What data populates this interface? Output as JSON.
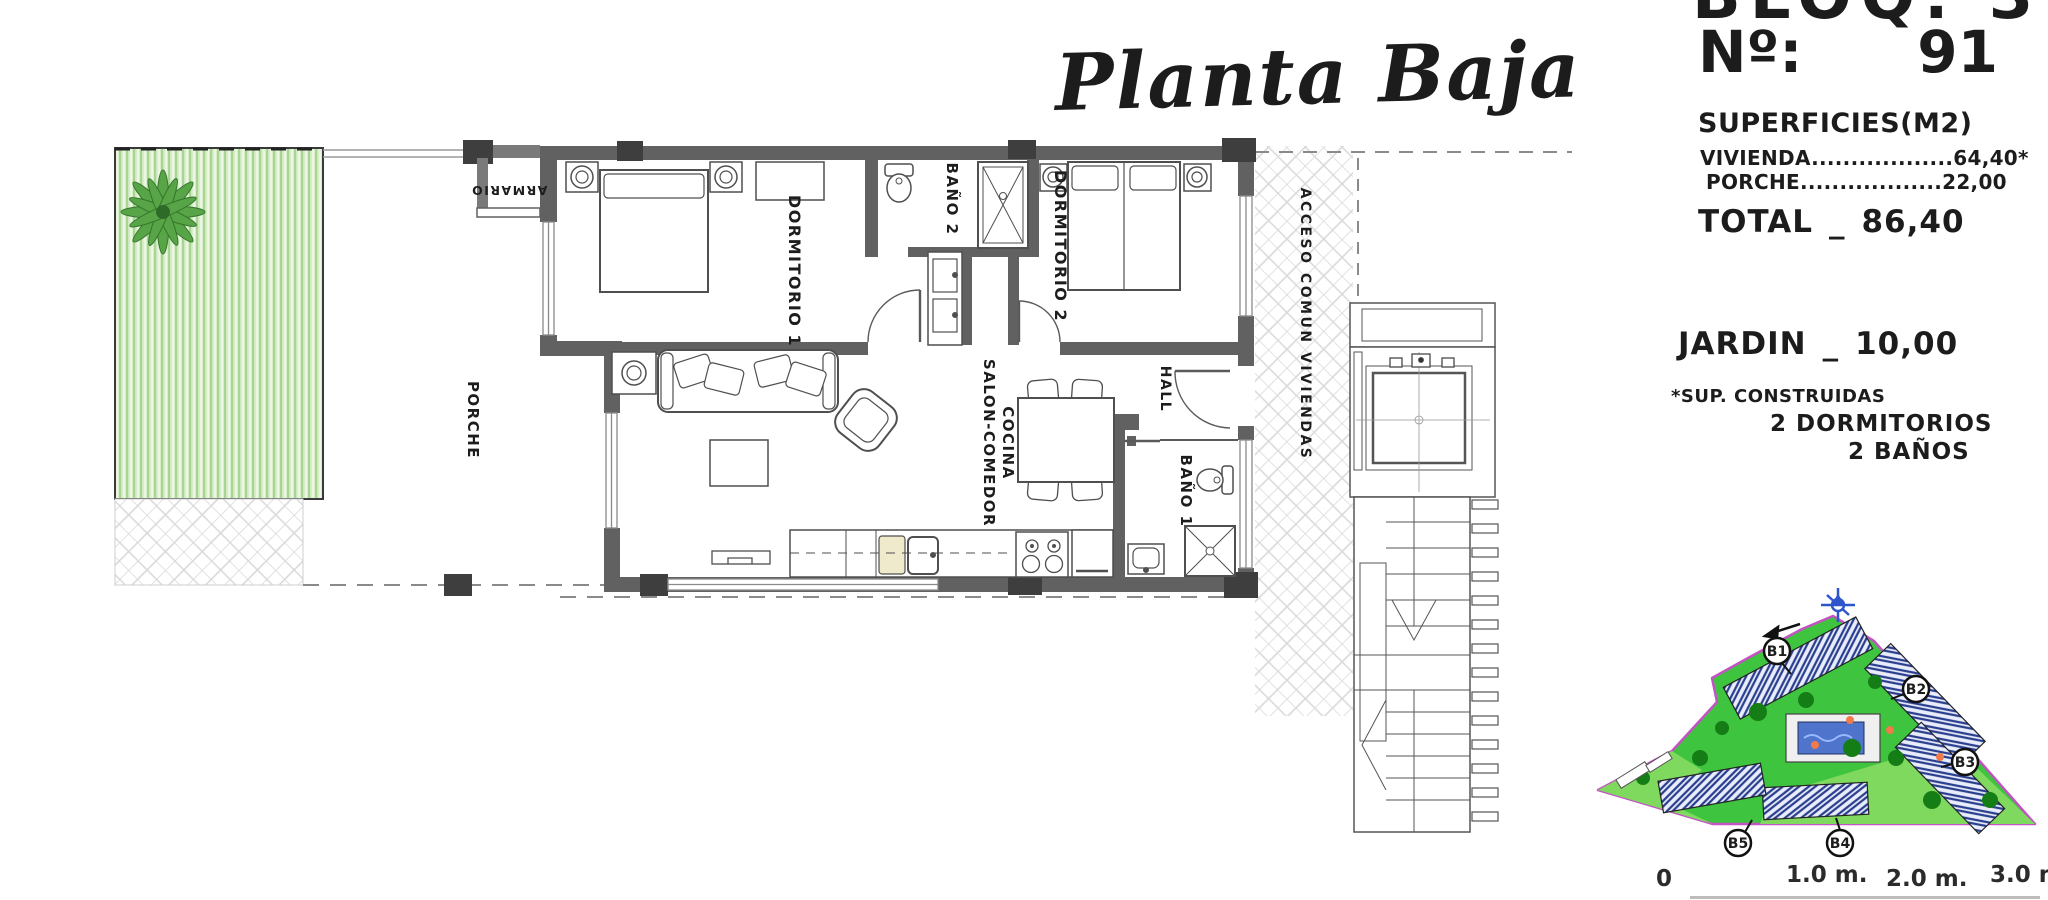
{
  "title": {
    "script": "Planta Baja"
  },
  "info_panel": {
    "block": "BLOQ. 3",
    "unit_label": "Nº:",
    "unit_number": "91",
    "surfaces_title": "SUPERFICIES(M2)",
    "rows": [
      {
        "label": "VIVIENDA",
        "leader": "..................",
        "value": "64,40*"
      },
      {
        "label": "PORCHE",
        "leader": "..................",
        "value": "22,00"
      }
    ],
    "total_label": "TOTAL",
    "total_sep": "_",
    "total_value": "86,40",
    "jardin_label": "JARDIN",
    "jardin_sep": "_",
    "jardin_value": "10,00",
    "footnote": "*SUP. CONSTRUIDAS",
    "feature_bedrooms": "2 DORMITORIOS",
    "feature_bathrooms": "2 BAÑOS"
  },
  "floorplan": {
    "rooms": {
      "porche": "PORCHE",
      "armario": "ARMARIO",
      "dormitorio1": "DORMITORIO 1",
      "bano2": "BAÑO 2",
      "dormitorio2": "DORMITORIO 2",
      "salon_line1": "SALON-COMEDOR",
      "salon_line2": "COCINA",
      "hall": "HALL",
      "bano1": "BAÑO 1",
      "acceso": "ACCESO COMUN VIVIENDAS"
    }
  },
  "siteplan": {
    "labels": {
      "b1": "B1",
      "b2": "B2",
      "b3": "B3",
      "b4": "B4",
      "b5": "B5"
    }
  },
  "scalebar": {
    "t0": "0",
    "t1": "1.0 m.",
    "t2": "2.0 m.",
    "t3": "3.0 m."
  },
  "colors": {
    "wall": "#616161",
    "column": "#3e3e3e",
    "garden_base": "#d8eecb",
    "garden_stripe": "#a9d492",
    "site_green": "#3ec43e",
    "site_green_light": "#7fd95f",
    "boundary_magenta": "#c353c3",
    "pool_blue": "#4f74cc",
    "building_hatch_navy": "#2a3f8e",
    "tree_green": "#157d15",
    "accent_orange": "#f07a4a",
    "compass_blue": "#2f55cc",
    "text": "#1c1c1c"
  }
}
